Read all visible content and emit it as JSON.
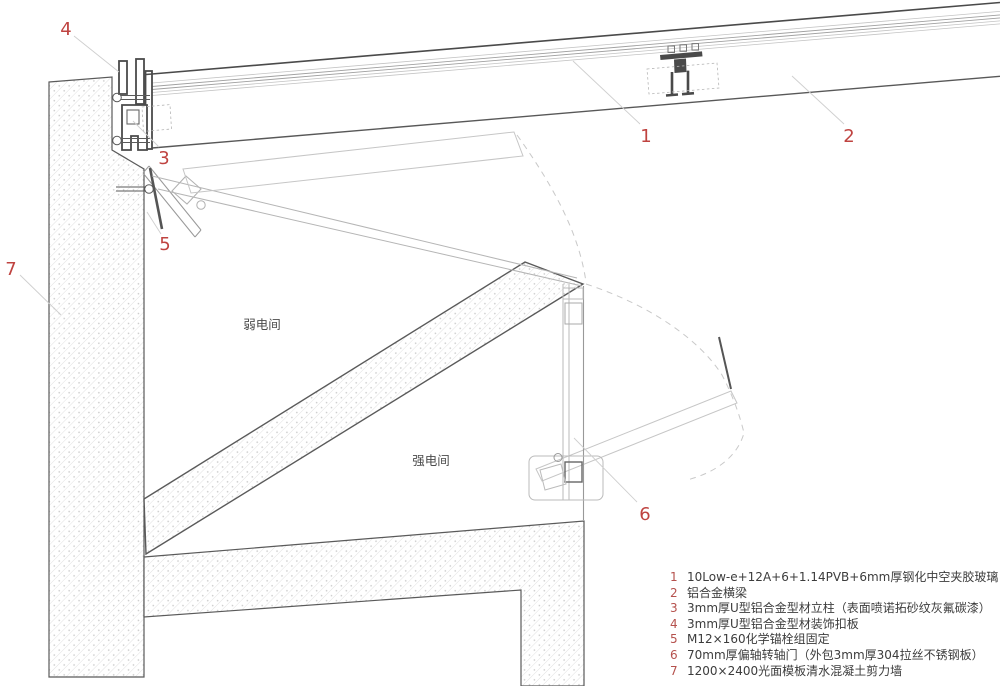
{
  "rooms": {
    "weak": "弱电间",
    "strong": "强电间"
  },
  "callouts": {
    "c1": "1",
    "c2": "2",
    "c3": "3",
    "c4": "4",
    "c5": "5",
    "c6": "6",
    "c7": "7"
  },
  "colors": {
    "callout_red": "#bf4340",
    "line_dark": "#4f4f4f",
    "line_light": "#c2c2c2",
    "hatch_line": "#dedede"
  },
  "legend": {
    "items": [
      {
        "num": "1",
        "text": "10Low-e+12A+6+1.14PVB+6mm厚钢化中空夹胶玻璃"
      },
      {
        "num": "2",
        "text": "铝合金横梁"
      },
      {
        "num": "3",
        "text": "3mm厚U型铝合金型材立柱（表面喷诺拓砂纹灰氟碳漆）"
      },
      {
        "num": "4",
        "text": "3mm厚U型铝合金型材装饰扣板"
      },
      {
        "num": "5",
        "text": "M12×160化学锚栓组固定"
      },
      {
        "num": "6",
        "text": "70mm厚偏轴转轴门（外包3mm厚304拉丝不锈钢板）"
      },
      {
        "num": "7",
        "text": "1200×2400光面模板清水混凝土剪力墙"
      }
    ]
  }
}
